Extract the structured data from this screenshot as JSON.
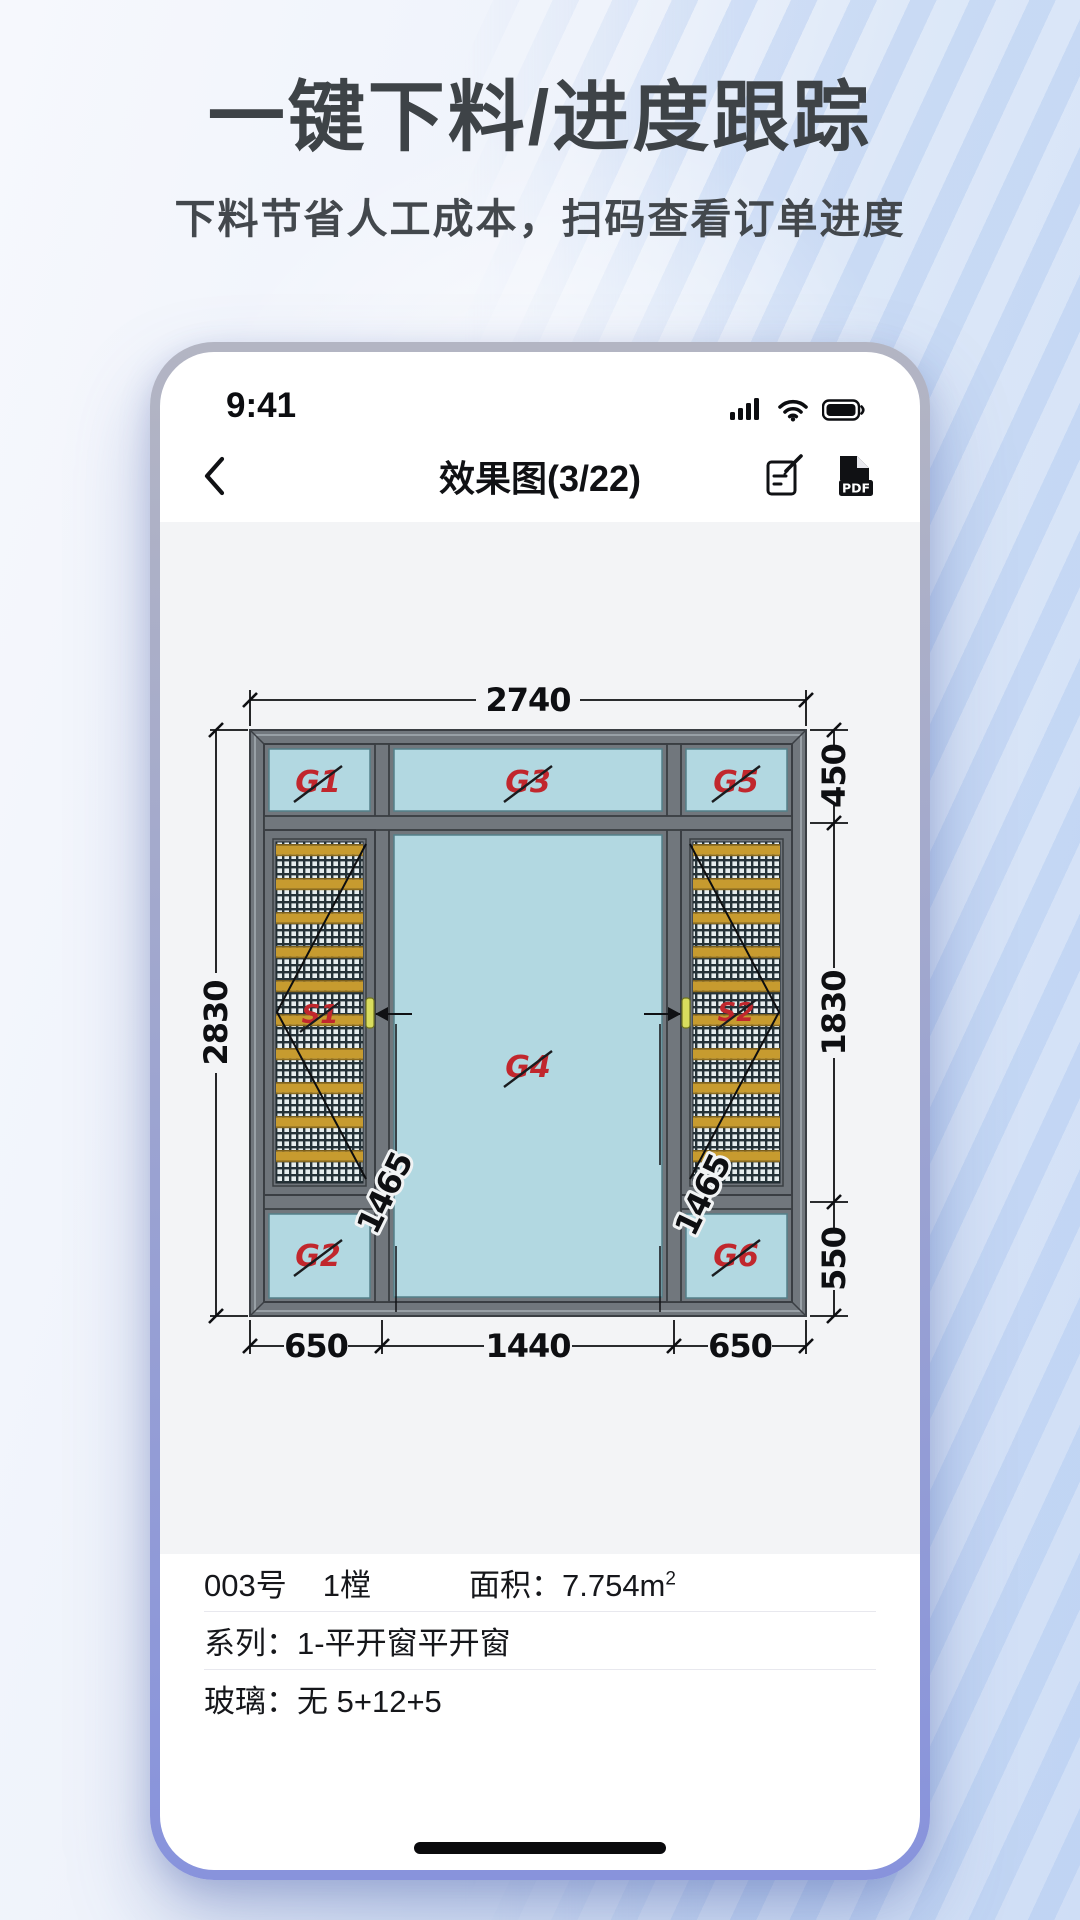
{
  "hero": {
    "title": "一键下料/进度跟踪",
    "subtitle": "下料节省人工成本，扫码查看订单进度"
  },
  "phone": {
    "status": {
      "time": "9:41"
    },
    "nav": {
      "title": "效果图(3/22)",
      "pdf_badge": "PDF"
    },
    "drawing": {
      "type": "window-elevation",
      "dims": {
        "total_width": "2740",
        "total_height": "2830",
        "right_segments": [
          "450",
          "1830",
          "550"
        ],
        "bottom_segments": [
          "650",
          "1440",
          "650"
        ],
        "sash_left_handle": "1465",
        "sash_right_handle": "1465"
      },
      "labels": {
        "g1": "G1",
        "g2": "G2",
        "g3": "G3",
        "g4": "G4",
        "g5": "G5",
        "g6": "G6",
        "s1": "S1",
        "s2": "S2"
      },
      "colors": {
        "glass": "#b2d8e1",
        "frame": "#71777d",
        "bar": "#c79b2f",
        "label_red": "#c1272d"
      }
    },
    "info": {
      "order_no": "003号",
      "qty": "1樘",
      "area_label": "面积：",
      "area_value": "7.754m",
      "area_sup": "2",
      "series": "系列：1-平开窗平开窗",
      "glass": "玻璃：无 5+12+5"
    }
  }
}
